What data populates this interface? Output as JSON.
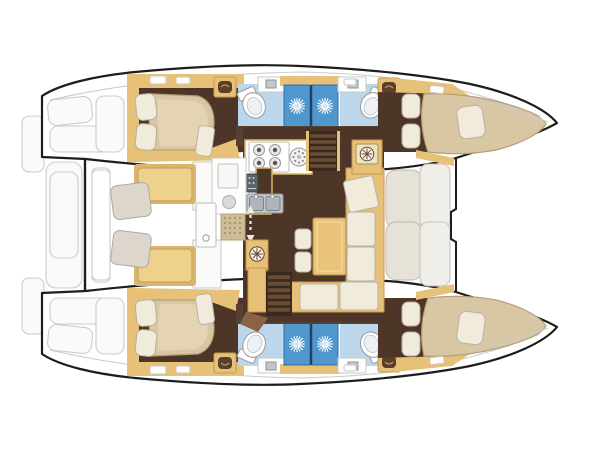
{
  "document": {
    "title": "Catamaran interior layout — top-view floor plan",
    "view": "overhead deck/accommodation plan, bows pointing right, sterns left"
  },
  "colors": {
    "outline": "#1d1d1b",
    "faint": "#c9ccd0",
    "wood": "#e6c177",
    "woodDark": "#c79b4e",
    "floorBrown": "#4d3628",
    "walkBrown": "#8a6347",
    "bedBeige": "#d9c6a2",
    "cream": "#f1ebdb",
    "bathBlue": "#bcd7eb",
    "showerBlue": "#4f97cc",
    "benchYellow": "#eed18a",
    "taupe": "#ddd6cd",
    "tableWood": "#e8c379"
  },
  "vessel": {
    "type": "sailing catamaran accommodation plan",
    "hulls": [
      {
        "name": "port hull (top)",
        "features": [
          "transom steps (faint)",
          "aft double-berth cabin with 2 pillows",
          "aft bathroom: toilet, washbasin, counter",
          "two blue shower stalls with drain rosettes",
          "forward bathroom: toilet, washbasin, counter",
          "forward double-berth cabin with pillows",
          "hull walkway",
          "deck hatches"
        ]
      },
      {
        "name": "starboard hull (bottom)",
        "features": [
          "mirror image of port hull: aft cabin, bathroom, two showers, forward bathroom, forward cabin"
        ]
      }
    ],
    "bridgedeck": {
      "aft_cockpit": [
        "two yellow bench cushions",
        "two taupe helm/side seats",
        "aft crossbeam",
        "transom platform (faint)"
      ],
      "salon": [
        "galley four-burner stove",
        "round hob/basin",
        "double stainless sink with faucets",
        "dark worktop",
        "microwave/oven",
        "refrigerator sideboard with round basin",
        "entry doormat",
        "up-down companionway arrow marker",
        "stairs down to port hull",
        "stairs down to starboard hull",
        "rectangular dining table",
        "L-shaped sofa with cream cushions",
        "two stools",
        "nav cabinet with vent rosette",
        "sliding entry door with round pull"
      ],
      "forward_cockpit": [
        "molded bench seats (faint)",
        "forward crossbar with footwell notch"
      ]
    },
    "counts": {
      "cabins": 4,
      "bathrooms": 4,
      "shower_stalls": 4,
      "companionway_stairs": 2
    }
  }
}
